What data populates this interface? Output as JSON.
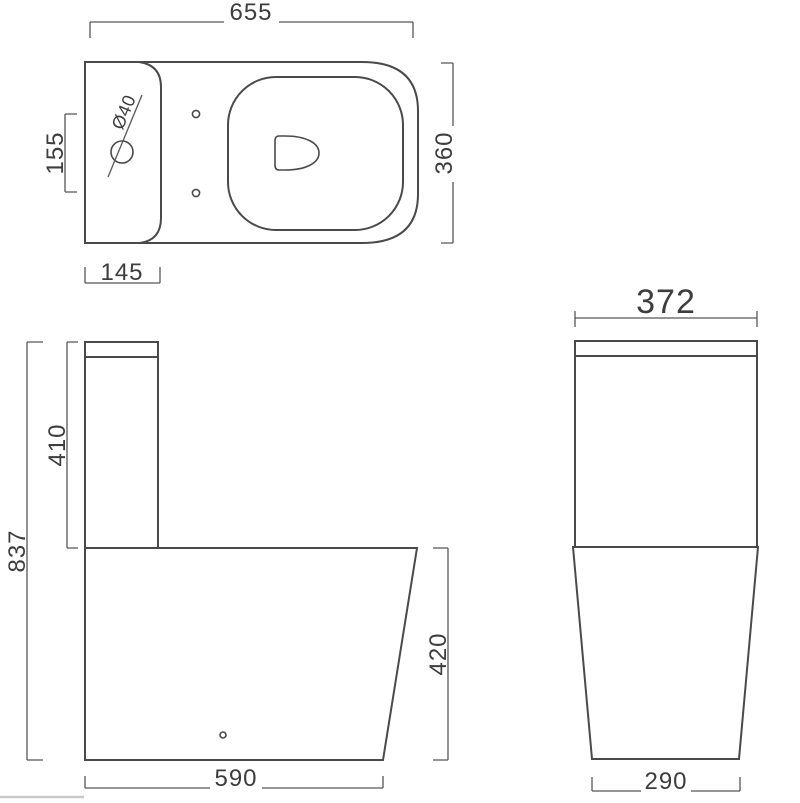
{
  "document": {
    "type": "technical-drawing",
    "subject": "close-coupled toilet dimensioned line drawing",
    "unit": "mm"
  },
  "colors": {
    "background": "#ffffff",
    "object_line": "#4a4a4a",
    "dimension_line": "#565656",
    "text": "#3d3d3d"
  },
  "views": {
    "top_view": {
      "label": "plan view",
      "dimensions": {
        "overall_width": "655",
        "overall_depth": "360",
        "fixing_hole_spacing": "155",
        "cistern_depth": "145",
        "inlet_hole_diameter": "Ø40"
      }
    },
    "side_view": {
      "label": "side elevation",
      "dimensions": {
        "overall_height": "837",
        "cistern_height": "410",
        "bowl_height": "420",
        "base_depth": "590"
      }
    },
    "front_view": {
      "label": "front elevation",
      "dimensions": {
        "cistern_width": "372",
        "base_width": "290"
      }
    }
  }
}
